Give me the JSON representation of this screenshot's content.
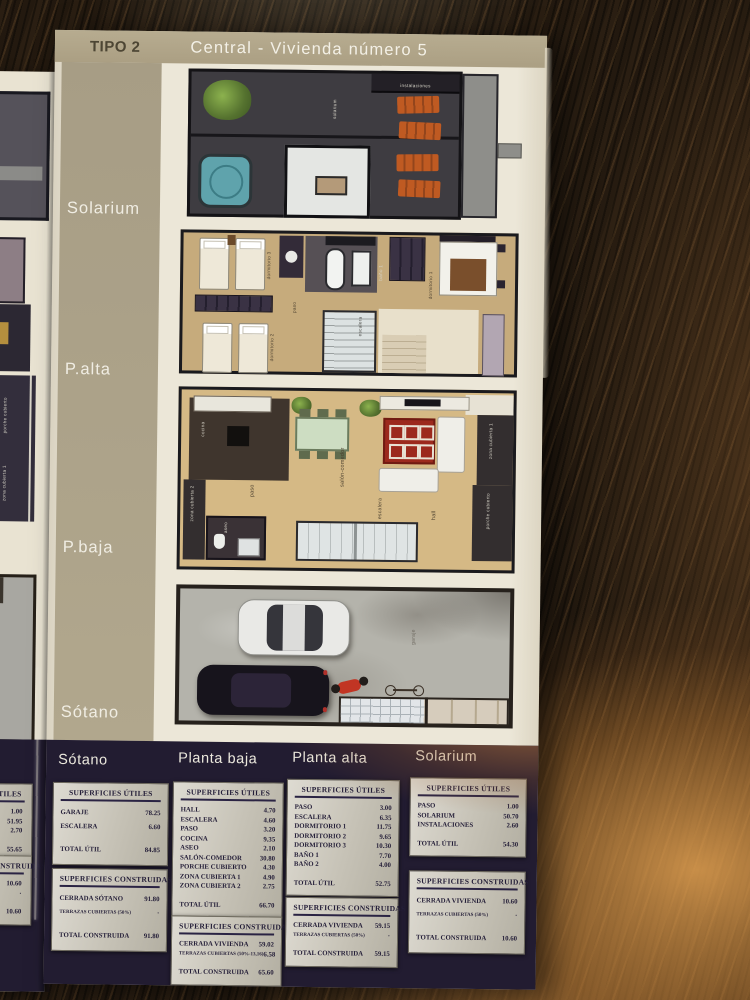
{
  "header": {
    "type_label": "TIPO 2",
    "title": "Central - Vivienda número  5"
  },
  "side_labels": {
    "solarium": "Solarium",
    "alta": "P.alta",
    "baja": "P.baja",
    "sotano": "Sótano"
  },
  "plans": {
    "solarium": {
      "labels": {
        "solarium": "solarium",
        "instalaciones": "instalaciones"
      }
    },
    "alta": {
      "labels": {
        "dormitorio1": "dormitorio 1",
        "dormitorio2": "dormitorio 2",
        "dormitorio3": "dormitorio 3",
        "bano1": "baño 1",
        "escalera": "escalera",
        "paso": "paso"
      }
    },
    "baja": {
      "labels": {
        "cocina": "cocina",
        "paso": "paso",
        "salon": "salón-comedor",
        "escalera": "escalera",
        "hall": "hall",
        "aseo": "aseo",
        "zona1": "zona cubierta 1",
        "zona2": "zona cubierta 2",
        "porche": "porche cubierto"
      }
    },
    "sotano": {
      "labels": {
        "garaje": "garaje"
      }
    }
  },
  "footer": {
    "columns": [
      {
        "name": "Sótano",
        "utiles_title": "SUPERFICIES ÚTILES",
        "utiles_rows": [
          {
            "label": "GARAJE",
            "value": "78.25"
          },
          {
            "label": "ESCALERA",
            "value": "6.60"
          }
        ],
        "utiles_total": {
          "label": "TOTAL ÚTIL",
          "value": "84.85"
        },
        "construidas_title": "SUPERFICIES CONSTRUIDAS",
        "construidas_rows": [
          {
            "label": "CERRADA SÓTANO",
            "value": "91.80"
          },
          {
            "label": "TERRAZAS CUBIERTAS (50%)",
            "value": "·",
            "small": true
          }
        ],
        "construidas_total": {
          "label": "TOTAL CONSTRUIDA",
          "value": "91.80"
        }
      },
      {
        "name": "Planta baja",
        "utiles_title": "SUPERFICIES ÚTILES",
        "utiles_rows": [
          {
            "label": "HALL",
            "value": "4.70"
          },
          {
            "label": "ESCALERA",
            "value": "4.60"
          },
          {
            "label": "PASO",
            "value": "3.20"
          },
          {
            "label": "COCINA",
            "value": "9.35"
          },
          {
            "label": "ASEO",
            "value": "2.10"
          },
          {
            "label": "SALÓN-COMEDOR",
            "value": "30.80"
          },
          {
            "label": "PORCHE CUBIERTO",
            "value": "4.30"
          },
          {
            "label": "ZONA CUBIERTA 1",
            "value": "4.90"
          },
          {
            "label": "ZONA CUBIERTA 2",
            "value": "2.75"
          }
        ],
        "utiles_total": {
          "label": "TOTAL ÚTIL",
          "value": "66.70"
        },
        "construidas_title": "SUPERFICIES CONSTRUIDAS",
        "construidas_rows": [
          {
            "label": "CERRADA VIVIENDA",
            "value": "59.02"
          },
          {
            "label": "TERRAZAS CUBIERTAS (50%-13,16)",
            "value": "6.58",
            "small": true
          }
        ],
        "construidas_total": {
          "label": "TOTAL CONSTRUIDA",
          "value": "65.60"
        }
      },
      {
        "name": "Planta alta",
        "utiles_title": "SUPERFICIES ÚTILES",
        "utiles_rows": [
          {
            "label": "PASO",
            "value": "3.00"
          },
          {
            "label": "ESCALERA",
            "value": "6.35"
          },
          {
            "label": "DORMITORIO 1",
            "value": "11.75"
          },
          {
            "label": "DORMITORIO 2",
            "value": "9.65"
          },
          {
            "label": "DORMITORIO 3",
            "value": "10.30"
          },
          {
            "label": "BAÑO 1",
            "value": "7.70"
          },
          {
            "label": "BAÑO 2",
            "value": "4.00"
          }
        ],
        "utiles_total": {
          "label": "TOTAL ÚTIL",
          "value": "52.75"
        },
        "construidas_title": "SUPERFICIES CONSTRUIDAS",
        "construidas_rows": [
          {
            "label": "CERRADA VIVIENDA",
            "value": "59.15"
          },
          {
            "label": "TERRAZAS CUBIERTAS (50%)",
            "value": "·",
            "small": true
          }
        ],
        "construidas_total": {
          "label": "TOTAL CONSTRUIDA",
          "value": "59.15"
        }
      },
      {
        "name": "Solarium",
        "utiles_title": "SUPERFICIES ÚTILES",
        "utiles_rows": [
          {
            "label": "PASO",
            "value": "1.00"
          },
          {
            "label": "SOLARIUM",
            "value": "50.70"
          },
          {
            "label": "INSTALACIONES",
            "value": "2.60"
          }
        ],
        "utiles_total": {
          "label": "TOTAL ÚTIL",
          "value": "54.30"
        },
        "construidas_title": "SUPERFICIES CONSTRUIDAS",
        "construidas_rows": [
          {
            "label": "CERRADA VIVIENDA",
            "value": "10.60"
          },
          {
            "label": "TERRAZAS CUBIERTAS (50%)",
            "value": "·",
            "small": true
          }
        ],
        "construidas_total": {
          "label": "TOTAL CONSTRUIDA",
          "value": "10.60"
        }
      }
    ]
  },
  "left_page": {
    "frag_porche": "porche cubierto",
    "frag_zona": "zona cubierta 1",
    "utiles_title": "SUPERFICIES ÚTILES",
    "utiles_rows": [
      {
        "label": "",
        "value": "1.00"
      },
      {
        "label": "",
        "value": "51.95"
      },
      {
        "label": "",
        "value": "2.70"
      }
    ],
    "utiles_total": {
      "label": "",
      "value": "55.65"
    },
    "construidas_title": "SUPERFICIES CONSTRUIDAS",
    "construidas_rows": [
      {
        "label": "",
        "value": "10.60"
      },
      {
        "label": "",
        "value": "·",
        "small": true
      }
    ],
    "construidas_total": {
      "label": "",
      "value": "10.60"
    }
  }
}
